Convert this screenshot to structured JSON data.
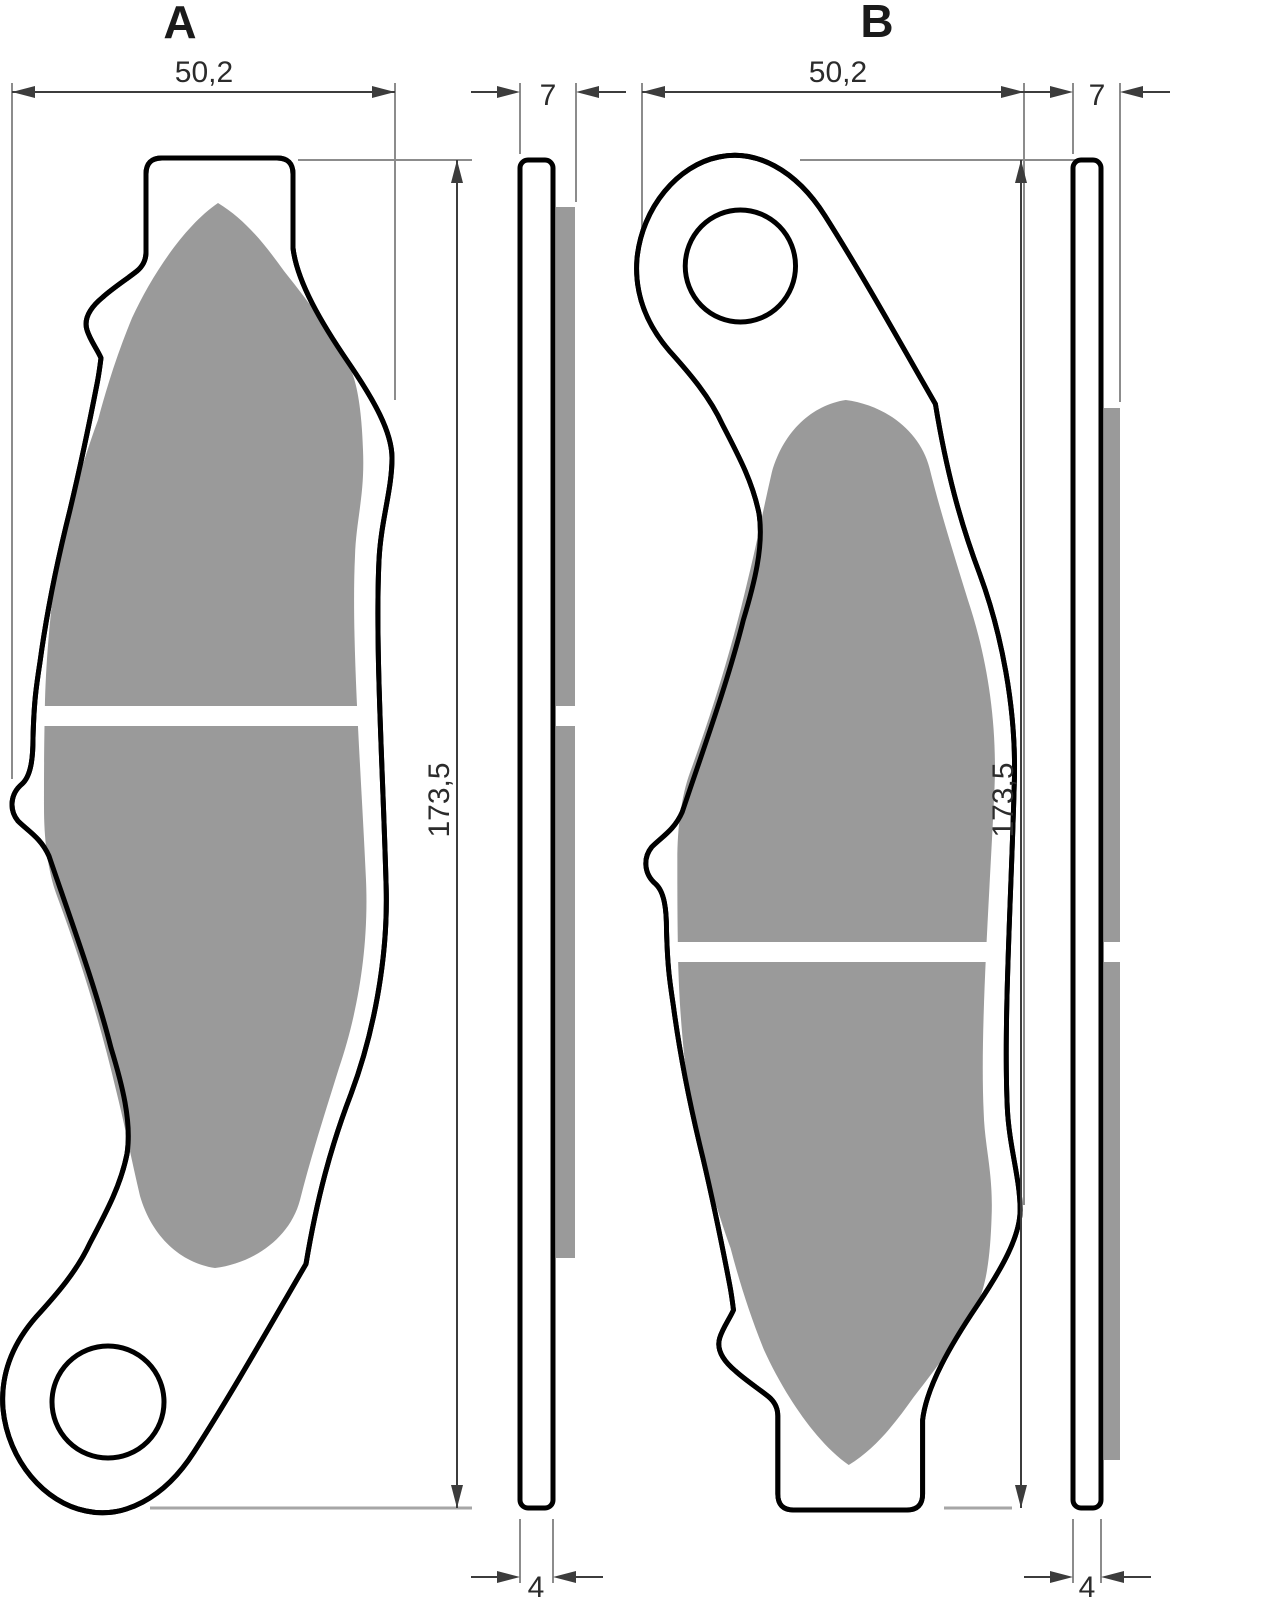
{
  "drawing": {
    "views": [
      {
        "id": "a",
        "label": "A",
        "dims": {
          "width": "50,2",
          "total_thickness": "7",
          "height": "173,5",
          "plate_thickness": "4"
        }
      },
      {
        "id": "b",
        "label": "B",
        "dims": {
          "width": "50,2",
          "total_thickness": "7",
          "height": "173,5",
          "plate_thickness": "4"
        }
      }
    ]
  },
  "colors": {
    "friction_material": "#9a9a9a",
    "outline": "#000000",
    "dimension": "#3c3c3c",
    "reference_line": "#a6a6a6",
    "background": "#ffffff"
  }
}
